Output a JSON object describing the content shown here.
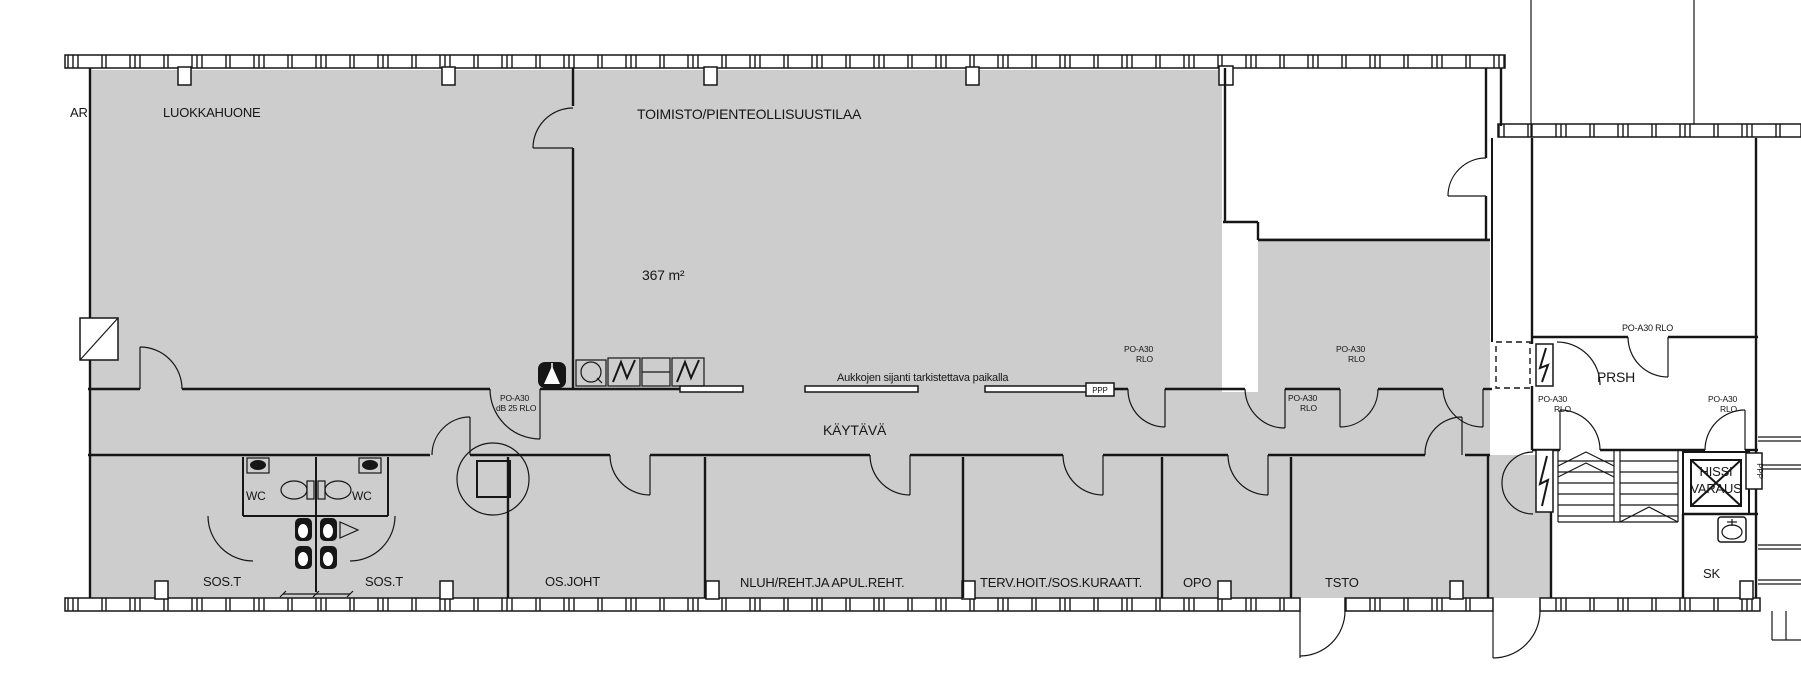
{
  "meta": {
    "type": "architectural-floor-plan",
    "colors": {
      "background": "#ffffff",
      "room_fill": "#cdcdcd",
      "line": "#161616"
    }
  },
  "rooms": {
    "ar": "AR",
    "luokkahuone": "LUOKKAHUONE",
    "toimisto": "TOIMISTO/PIENTEOLLISUUSTILAA",
    "toimisto_area": "367 m²",
    "kaytava": "KÄYTÄVÄ",
    "wc": "WC",
    "sos_t": "SOS.T",
    "os_joht": "OS.JOHT",
    "nluh": "NLUH/REHT.JA APUL.REHT.",
    "terv": "TERV.HOIT./SOS.KURAATT.",
    "opo": "OPO",
    "tsto": "TSTO",
    "prsh": "PRSH",
    "hissi_line1": "HISSI",
    "hissi_line2": "VARAUS",
    "sk": "SK"
  },
  "annotations": {
    "aukkojen": "Aukkojen sijanti tarkistettava paikalla",
    "ppp": "PPP",
    "po_a30": "PO-A30",
    "rlo": "RLO",
    "po_a30_rlo": "PO-A30 RLO",
    "db_25_rlo": "dB 25 RLO"
  }
}
